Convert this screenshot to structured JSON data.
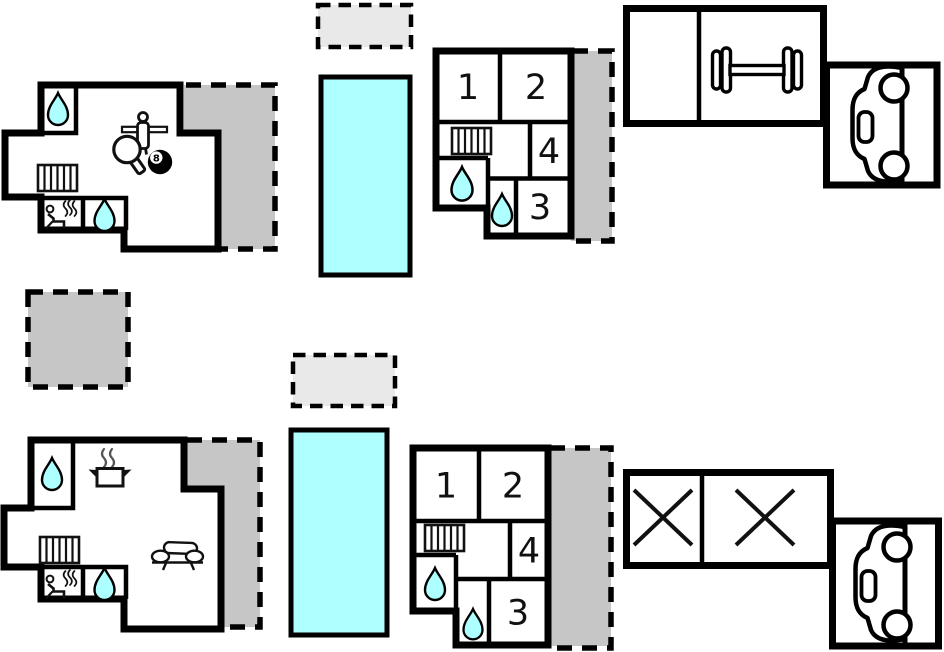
{
  "colors": {
    "walls": "#000000",
    "pool": "#aeffff",
    "terrace": "#c6c6c6",
    "patio": "#e9e9e9",
    "water_drop": "#aeffff",
    "background": "#ffffff"
  },
  "upper": {
    "annex_rooms": [
      {
        "label": "1"
      },
      {
        "label": "2"
      },
      {
        "label": "4"
      },
      {
        "label": "3"
      }
    ],
    "eight_ball": "8"
  },
  "lower": {
    "annex_rooms": [
      {
        "label": "1"
      },
      {
        "label": "2"
      },
      {
        "label": "4"
      },
      {
        "label": "3"
      }
    ]
  },
  "icons": {
    "water_drop": "teardrop",
    "radiator": "striped-rectangle",
    "sauna": "person-with-steam",
    "foosball_player": "figure-on-rod",
    "table_tennis_paddle": "paddle",
    "eight_ball": "billiard-ball-8",
    "cooking_pot": "pot-with-steam",
    "sofa": "couch-side-view",
    "dumbbell": "barbell",
    "car": "car-side-view",
    "crossed_room": "x-mark",
    "pool": "cyan-rectangle",
    "terrace": "gray-dashed-area"
  }
}
